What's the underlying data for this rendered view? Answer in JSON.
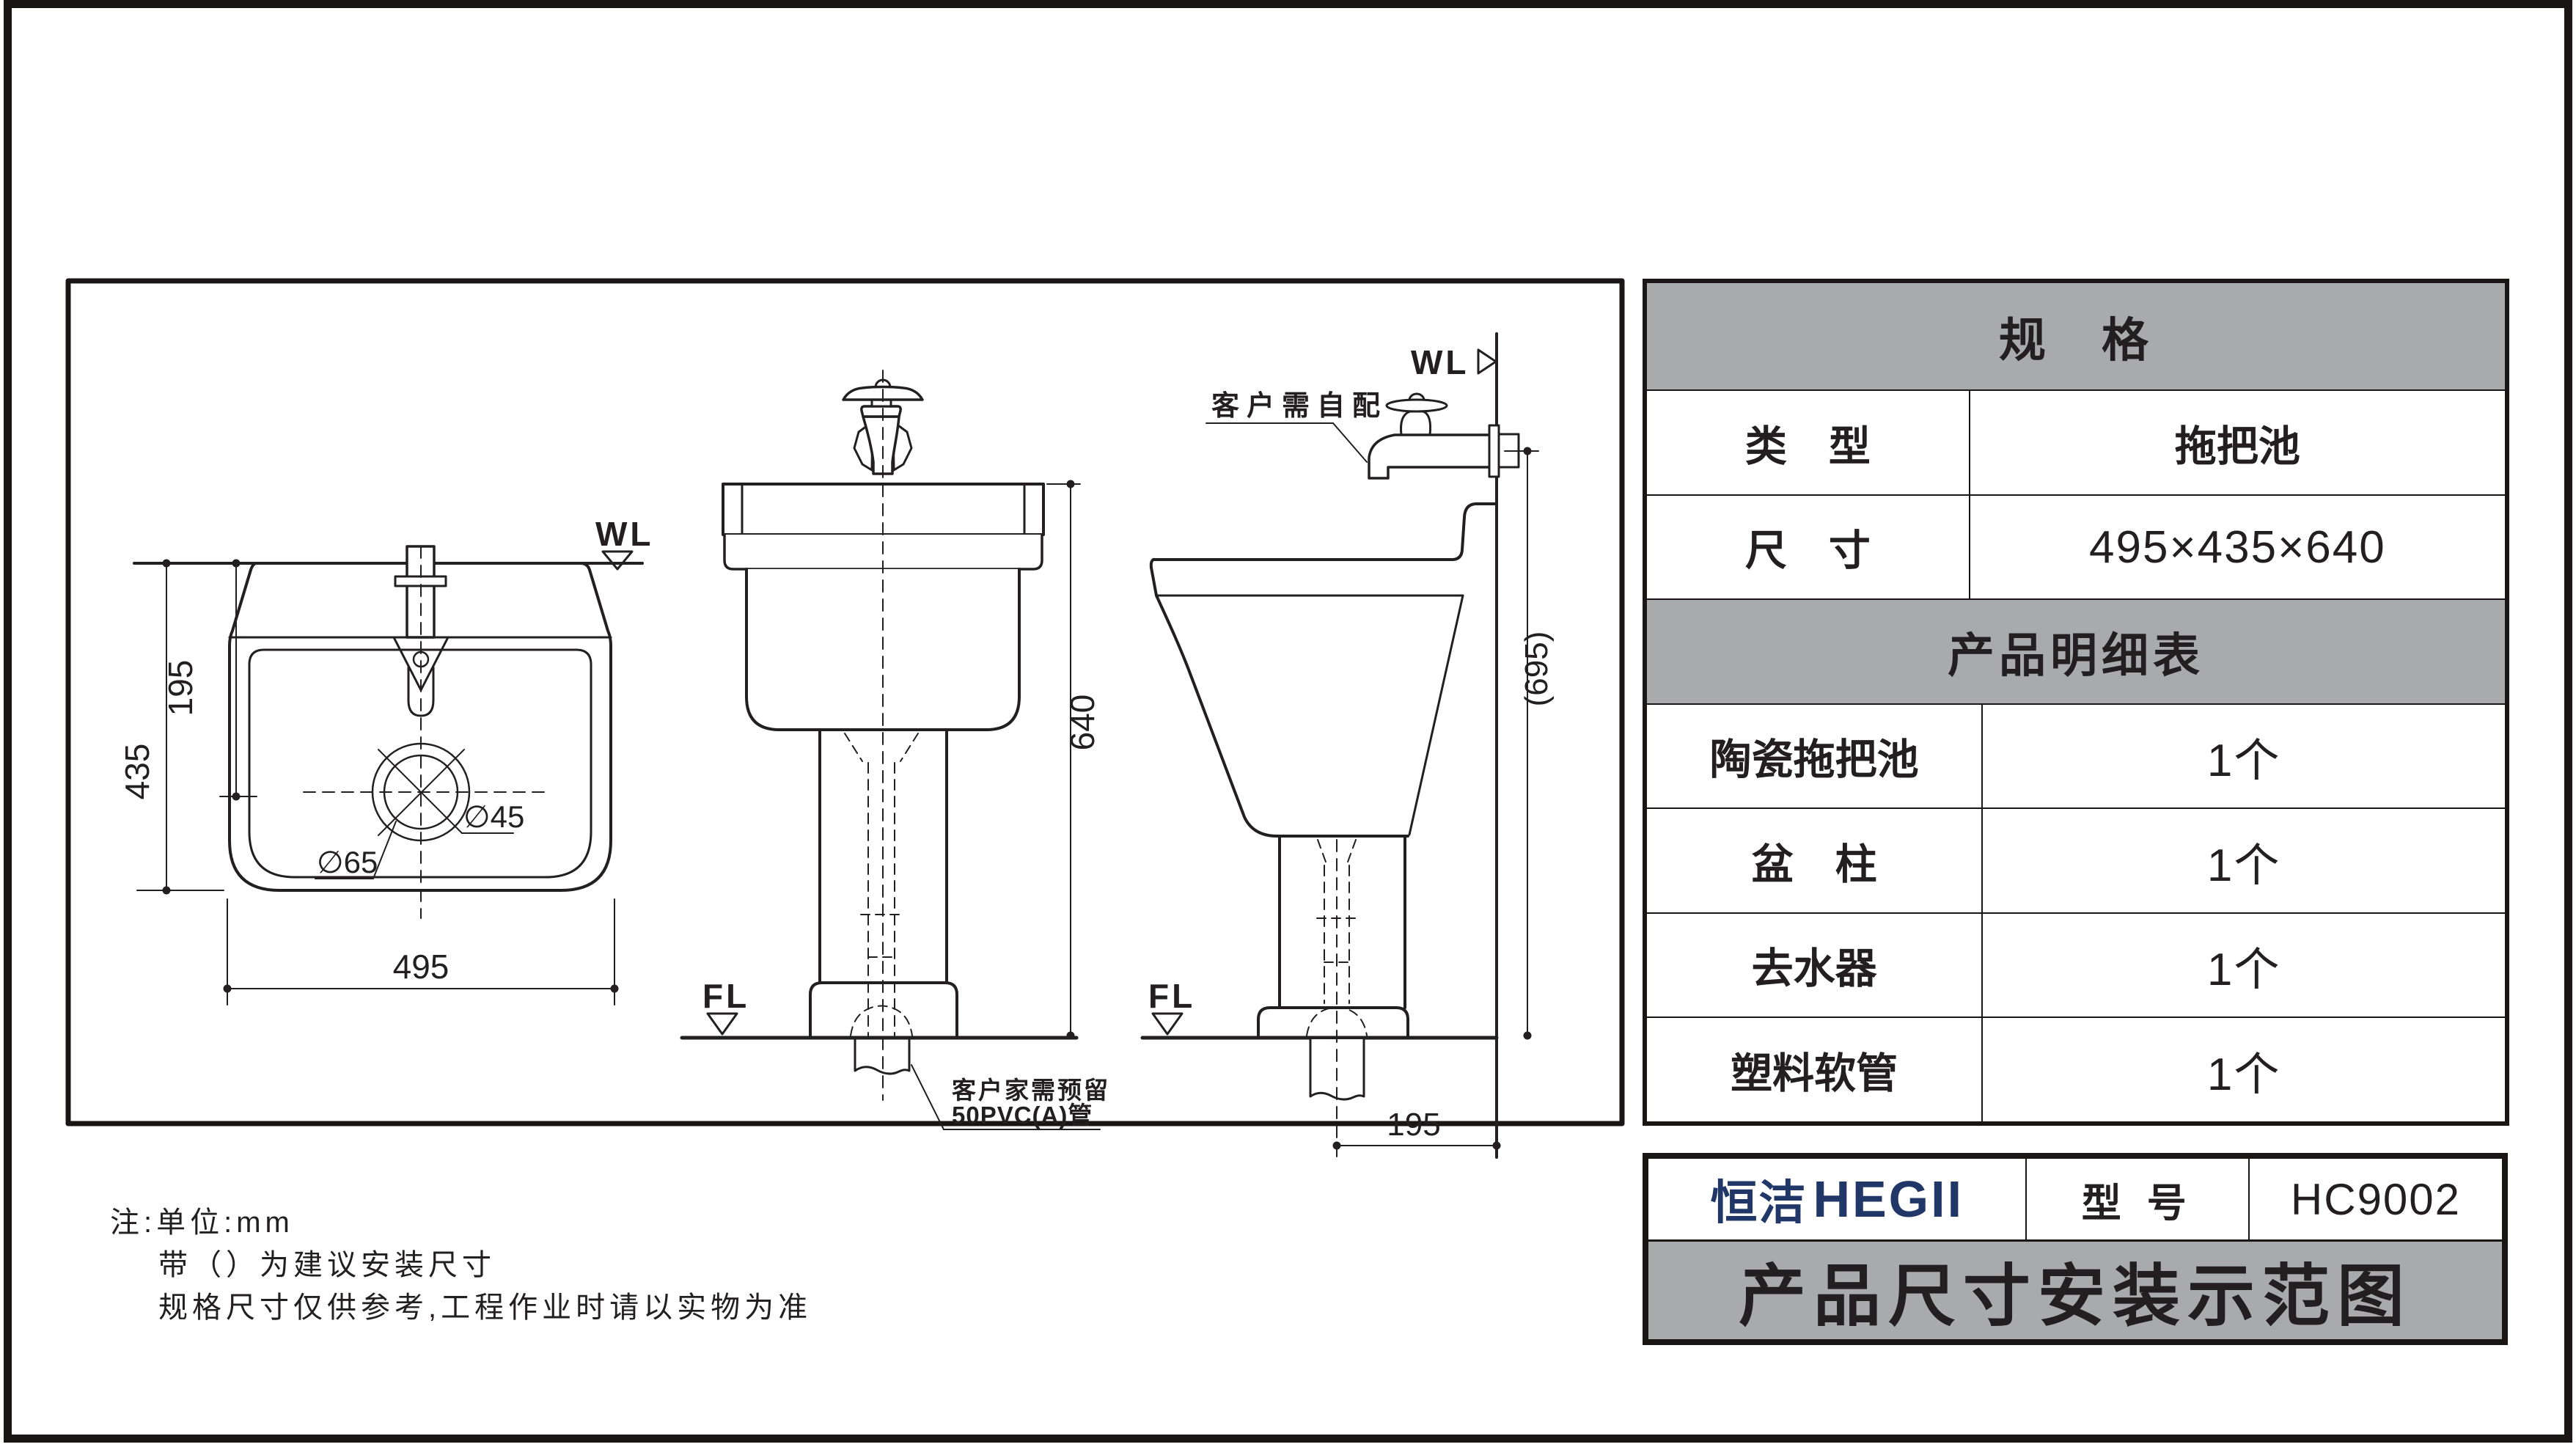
{
  "page": {
    "gray": "#a9aaab",
    "line_color": "#231f20",
    "logo_color": "#203768"
  },
  "drawing": {
    "top_view": {
      "wl_label": "WL",
      "dim_width": "495",
      "dim_depth": "435",
      "dim_center": "195",
      "drain_outer": "∅65",
      "drain_inner": "∅45"
    },
    "front_view": {
      "fl_label": "FL",
      "dim_height": "640",
      "leader_line1": "客户家需预留",
      "leader_line2": "50PVC(A)管"
    },
    "side_view": {
      "wl_label": "WL",
      "fl_label": "FL",
      "dim_height": "(695)",
      "dim_offset": "195",
      "leader": "客户需自配"
    }
  },
  "spec_table": {
    "header": "规　格",
    "rows": [
      {
        "label": "类　型",
        "value": "拖把池"
      },
      {
        "label": "尺　寸",
        "value": "495×435×640"
      }
    ],
    "detail_header": "产品明细表",
    "detail_rows": [
      {
        "label": "陶瓷拖把池",
        "value": "1个"
      },
      {
        "label": "盆　柱",
        "value": "1个"
      },
      {
        "label": "去水器",
        "value": "1个"
      },
      {
        "label": "塑料软管",
        "value": "1个"
      }
    ]
  },
  "brand_table": {
    "logo_cn": "恒洁",
    "logo_en": "HEGII",
    "model_label": "型 号",
    "model_value": "HC9002",
    "title": "产品尺寸安装示范图"
  },
  "notes": [
    "注:单位:mm",
    "带（）为建议安装尺寸",
    "规格尺寸仅供参考,工程作业时请以实物为准"
  ]
}
